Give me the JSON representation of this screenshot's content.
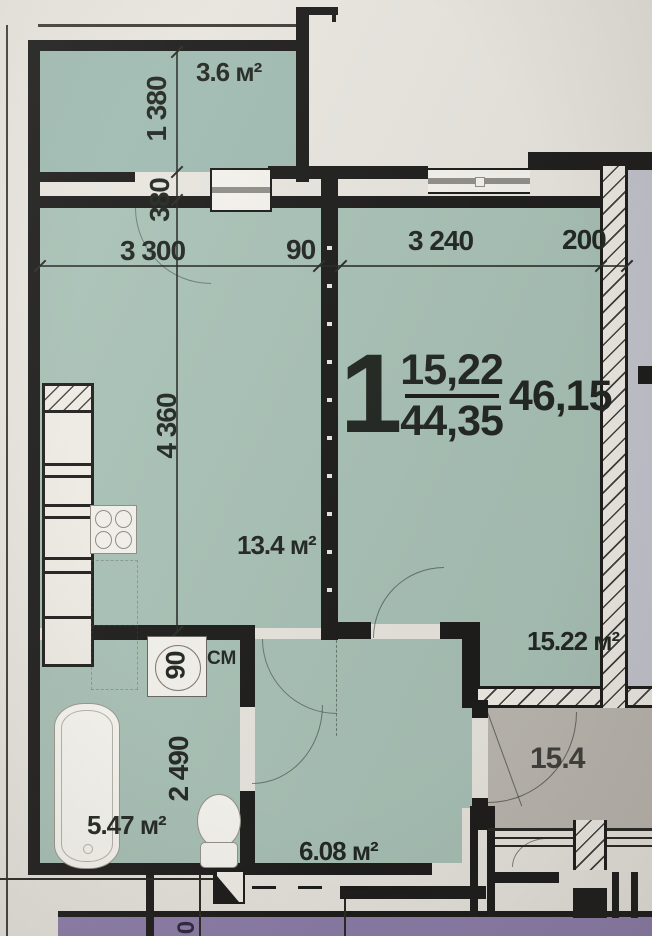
{
  "apartment": {
    "number": "1",
    "living_area": "15,22",
    "total_area": "44,35",
    "overall_area": "46,15"
  },
  "rooms": {
    "balcony": {
      "area": "3.6 м²"
    },
    "kitchen": {
      "area": "13.4 м²"
    },
    "living_room": {
      "area": "15.22 м²"
    },
    "bathroom": {
      "area": "5.47 м²"
    },
    "hallway": {
      "area": "6.08 м²"
    },
    "adjacent_room": {
      "area": "15.4"
    }
  },
  "dimensions": {
    "balcony_width": "1 380",
    "balcony_wall": "380",
    "kitchen_width": "3 300",
    "pier": "90",
    "living_width": "3 240",
    "outer_wall": "200",
    "kitchen_depth": "4 360",
    "bathroom_depth": "2 490",
    "niche_width": "90",
    "corridor_dim_partial": "0"
  },
  "labels": {
    "washing_machine": "СМ"
  },
  "colors": {
    "room_fill": "#a8c2b8",
    "balcony_fill": "#9fbcb4",
    "adjacent_fill": "#bcb8b2",
    "corridor_fill": "#8b7bab",
    "side_fill": "#c6c7d3",
    "background": "#eae8e2",
    "wall": "#161616"
  }
}
